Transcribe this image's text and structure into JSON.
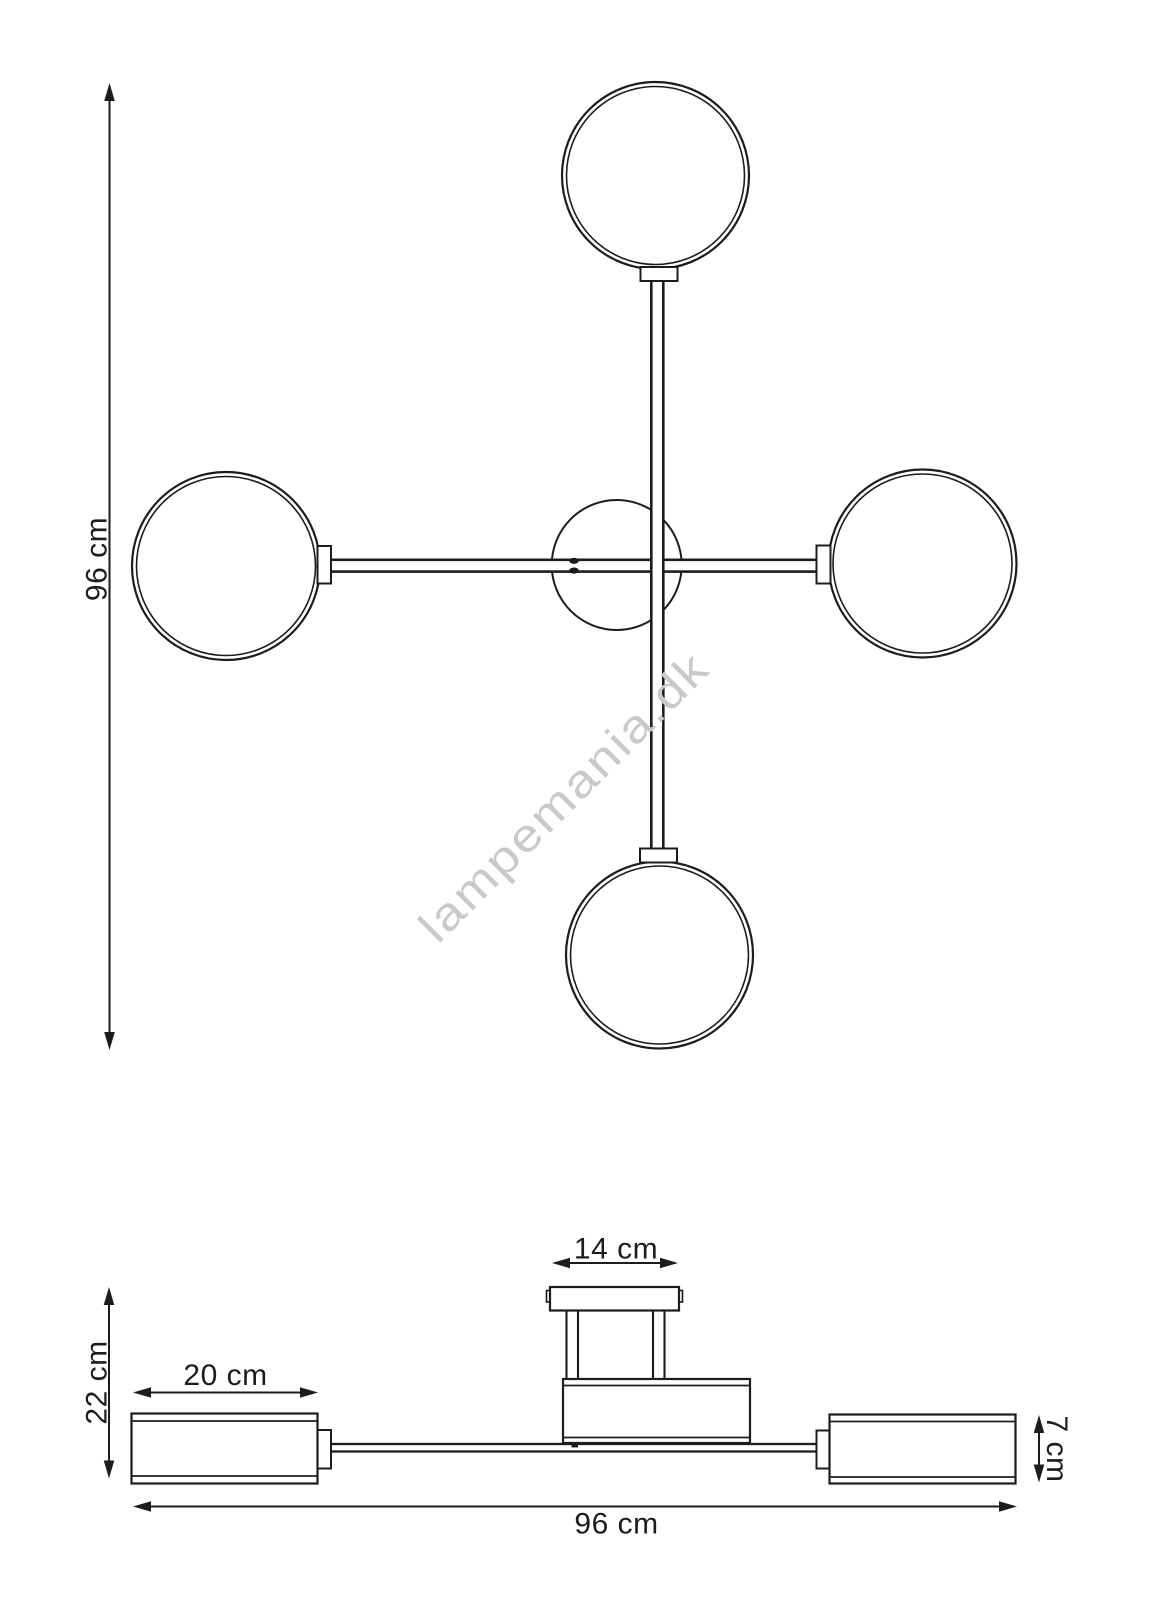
{
  "watermark": {
    "text": "lampemania.dk",
    "color": "#c9c9c9"
  },
  "colors": {
    "line": "#1c1c1c",
    "background": "#ffffff"
  },
  "top_view": {
    "dimensions": {
      "height": {
        "label": "96 cm",
        "value_cm": 96
      }
    }
  },
  "side_view": {
    "dimensions": {
      "canopy_width": {
        "label": "14 cm",
        "value_cm": 14
      },
      "fixture_height": {
        "label": "22 cm",
        "value_cm": 22
      },
      "shade_length": {
        "label": "20 cm",
        "value_cm": 20
      },
      "shade_height": {
        "label": "7 cm",
        "value_cm": 7
      },
      "total_width": {
        "label": "96 cm",
        "value_cm": 96
      }
    }
  }
}
